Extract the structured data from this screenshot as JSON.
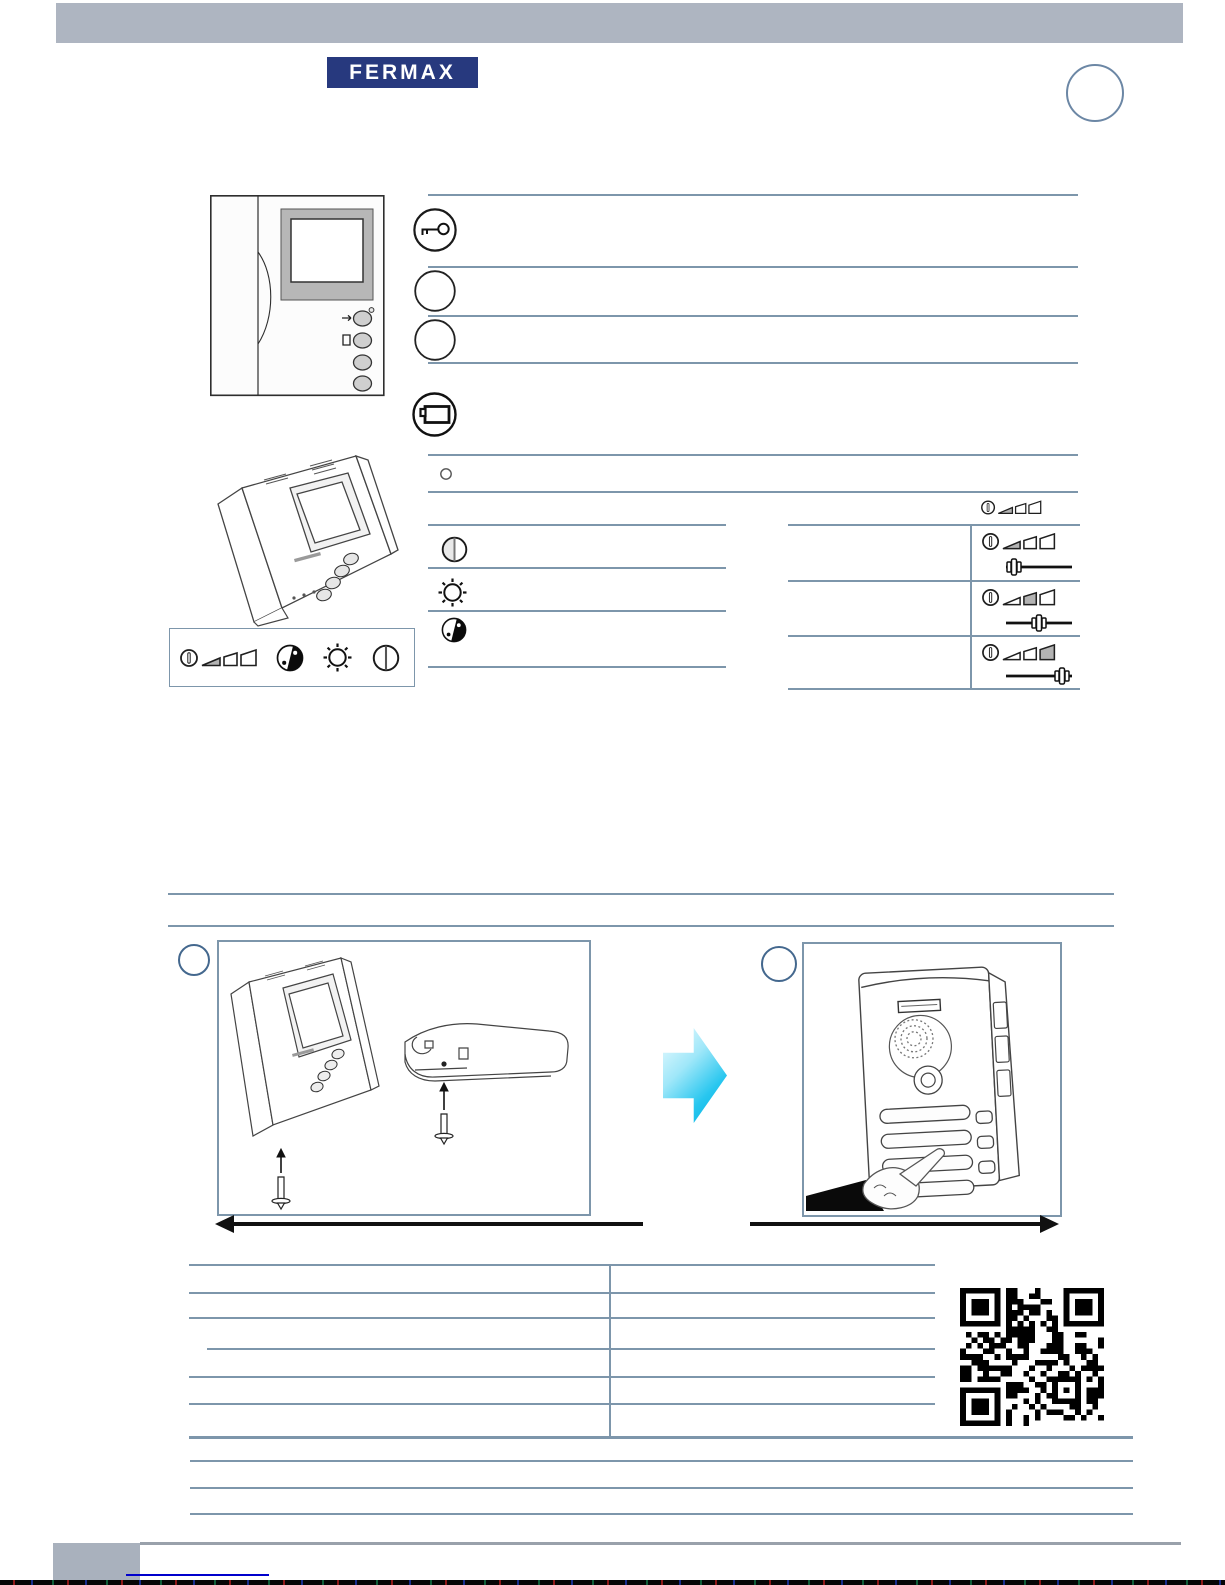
{
  "meta": {
    "page_width": 1225,
    "page_height": 1585,
    "background": "#ffffff"
  },
  "colors": {
    "header_bar": "#aeb5c1",
    "logo_bg": "#27397e",
    "logo_fg": "#ffffff",
    "rule": "#7d96ab",
    "badge_ring": "#44688e",
    "box_border": "#7d96ab",
    "ink": "#1f1f1f",
    "footer_gray_box": "#a9b1bd",
    "footer_gray_line": "#99a1ab",
    "footer_blue_line": "#0000cc",
    "blue_arrow_start": "#f0fcff",
    "blue_arrow_end": "#00b0e0"
  },
  "header": {
    "logo_text": "FERMAX",
    "corner_badge_shape": "circle"
  },
  "monitor_section": {
    "device_views": [
      "monitor-front-view",
      "monitor-perspective-view"
    ],
    "feature_rows": [
      {
        "icon": "door-key-icon"
      },
      {
        "icon": "circle-icon"
      },
      {
        "icon": "circle-icon"
      },
      {
        "icon": "camera-icon"
      },
      {
        "icon": "dot-circle-icon"
      },
      {
        "icon": "volume-levels-icon"
      }
    ],
    "feature_volume_icon_level": 1,
    "adjustment_rows": [
      {
        "icon": "contrast-icon"
      },
      {
        "icon": "brightness-icon"
      },
      {
        "icon": "colour-icon"
      }
    ],
    "volume_table_rows": [
      {
        "level": 1,
        "icon": "volume-low-icon",
        "slider_position": "left"
      },
      {
        "level": 2,
        "icon": "volume-medium-icon",
        "slider_position": "center"
      },
      {
        "level": 3,
        "icon": "volume-high-icon",
        "slider_position": "right"
      }
    ],
    "control_strip_icons": [
      "volume-levels-icon",
      "colour-icon",
      "brightness-icon",
      "contrast-icon"
    ]
  },
  "install_section": {
    "steps": [
      {
        "badge_shape": "circle",
        "diagram": "monitor-and-connector-screws"
      },
      {
        "badge_shape": "circle",
        "diagram": "door-panel-press-button"
      }
    ],
    "transition": "blue-right-arrow"
  },
  "spec_table": {
    "columns": 2,
    "data_rows": 6,
    "cells_empty": true
  },
  "footer": {
    "rule_rows": 3,
    "page_block": true,
    "link_underline": true
  },
  "qr": {
    "modules": 25,
    "seed": 73,
    "dark": "#000000",
    "light": "#ffffff"
  }
}
